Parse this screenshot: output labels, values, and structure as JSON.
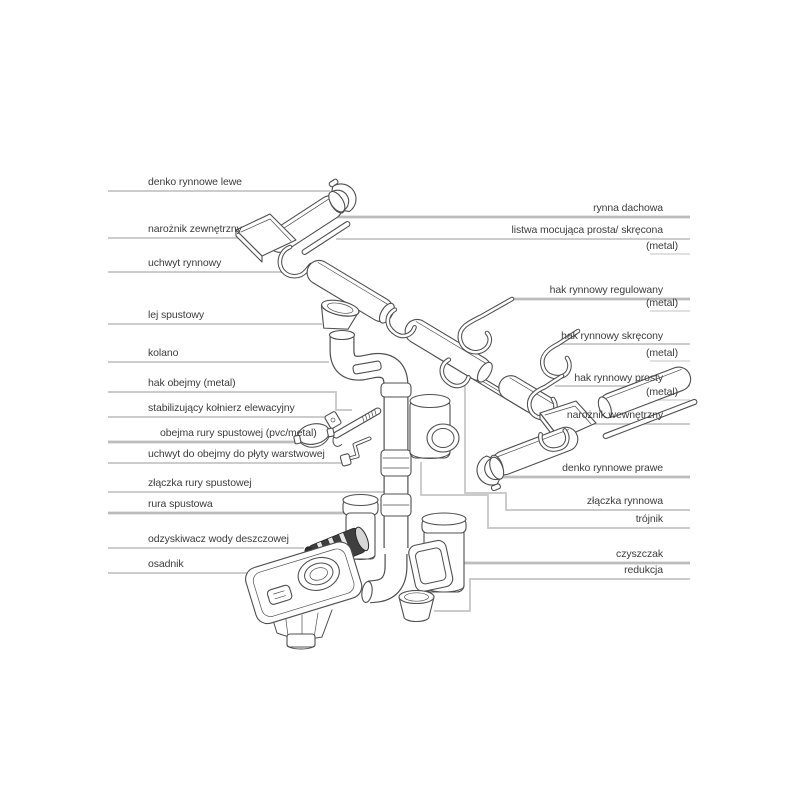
{
  "diagram_type": "gutter-system-exploded-parts-diagram",
  "colors": {
    "background": "#ffffff",
    "leader_line": "#c4c4c4",
    "ink": "#4f4f4f",
    "text": "#3c3c3c",
    "dark_part": "#3f3f3f"
  },
  "labels": {
    "left": [
      {
        "text": "denko rynnowe lewe"
      },
      {
        "text": "narożnik zewnętrzny"
      },
      {
        "text": "uchwyt rynnowy"
      },
      {
        "text": "lej spustowy"
      },
      {
        "text": "kolano"
      },
      {
        "text": "hak obejmy (metal)"
      },
      {
        "text": "stabilizujący kołnierz elewacyjny"
      },
      {
        "text": "obejma rury spustowej (pvc/metal)"
      },
      {
        "text": "uchwyt do obejmy do płyty warstwowej"
      },
      {
        "text": "złączka rury spustowej"
      },
      {
        "text": "rura spustowa"
      },
      {
        "text": "odzyskiwacz wody deszczowej"
      },
      {
        "text": "osadnik"
      }
    ],
    "right": [
      {
        "text": "rynna dachowa"
      },
      {
        "text": "listwa mocująca prosta/ skręcona",
        "sub": "(metal)"
      },
      {
        "text": "hak rynnowy regulowany",
        "sub": "(metal)"
      },
      {
        "text": "hak rynnowy skręcony",
        "sub": "(metal)"
      },
      {
        "text": "hak rynnowy prosty",
        "sub": "(metal)"
      },
      {
        "text": "narożnik wewnętrzny"
      },
      {
        "text": "denko rynnowe prawe"
      },
      {
        "text": "złączka rynnowa"
      },
      {
        "text": "trójnik"
      },
      {
        "text": "czyszczak"
      },
      {
        "text": "redukcja"
      }
    ]
  }
}
